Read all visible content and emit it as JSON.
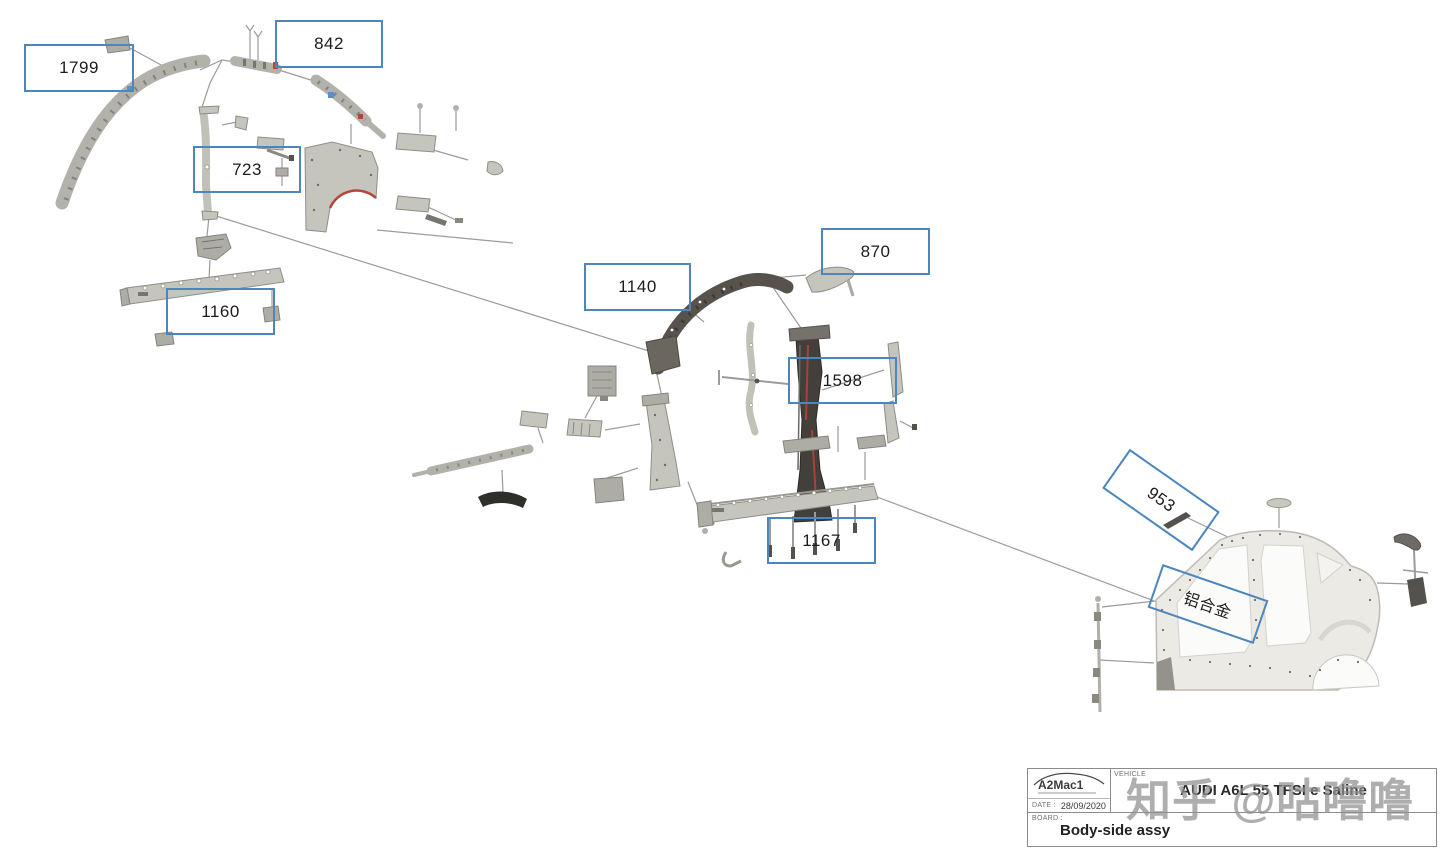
{
  "watermark": {
    "text": "知乎 @咕噜噜"
  },
  "labels": [
    {
      "text": "1799"
    },
    {
      "text": "842"
    },
    {
      "text": "723"
    },
    {
      "text": "1160"
    },
    {
      "text": "1140"
    },
    {
      "text": "870"
    },
    {
      "text": "1598"
    },
    {
      "text": "1167"
    },
    {
      "text": "953"
    },
    {
      "text": "铝合金"
    }
  ],
  "title_block": {
    "logo_text": "A2Mac1",
    "vehicle_label": "VEHICLE",
    "vehicle_value": "AUDI A6L 55 TFSI e Saline",
    "date_label": "DATE :",
    "date_value": "28/09/2020",
    "board_label": "BOARD :",
    "board_value": "Body-side assy"
  },
  "colors": {
    "label_box_border": "#4d86bd",
    "leader_line": "#9b9b9b",
    "accent_red": "#b5443a",
    "watermark_gray": "#8f8f8f"
  }
}
